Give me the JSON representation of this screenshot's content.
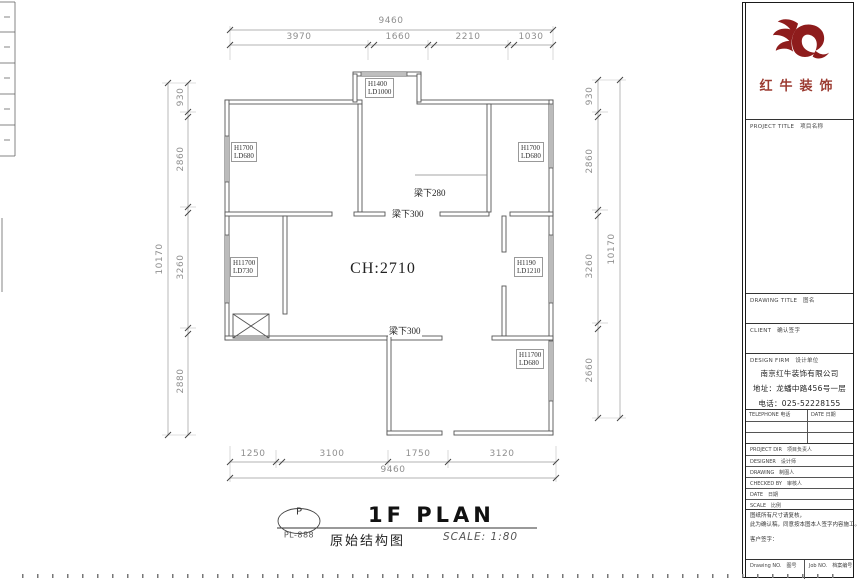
{
  "plan": {
    "bubble_letter": "P",
    "bubble_code": "PL-888",
    "drawing_name": "原始结构图",
    "title": "1F PLAN",
    "scale_label": "SCALE: 1:80",
    "ceiling_height": "CH:2710",
    "beams": {
      "beam1": "梁下280",
      "beam2": "梁下300",
      "beam3": "梁下300"
    },
    "windows": {
      "top_bay": {
        "l1": "H1400",
        "l2": "LD1000"
      },
      "left_top": {
        "l1": "H1700",
        "l2": "LD680"
      },
      "right_top": {
        "l1": "H1700",
        "l2": "LD680"
      },
      "left_mid": {
        "l1": "H11700",
        "l2": "LD730"
      },
      "right_mid": {
        "l1": "H1190",
        "l2": "LD1210"
      },
      "right_bottom": {
        "l1": "H11700",
        "l2": "LD680"
      }
    }
  },
  "dimensions": {
    "top": {
      "total": "9460",
      "segments": [
        "3970",
        "1660",
        "2210",
        "1030"
      ]
    },
    "bottom": {
      "total": "9460",
      "segments": [
        "1250",
        "3100",
        "1750",
        "3120"
      ]
    },
    "left": {
      "total": "10170",
      "segments": [
        "930",
        "2860",
        "3260",
        "2880"
      ]
    },
    "right": {
      "total": "10170",
      "segments": [
        "930",
        "2860",
        "3260",
        "2660"
      ]
    }
  },
  "title_block": {
    "brand": "红牛装饰",
    "project_title_head": "PROJECT TITLE　项目名称",
    "drawing_title_head": "DRAWING TITLE　图名",
    "client_head": "CLIENT　确认签字",
    "firm_head": "DESIGN FIRM　设计单位",
    "company_name": "南京红牛装饰有限公司",
    "company_address": "地址：龙蟠中路456号一层",
    "company_phone": "电话：025-52228155",
    "contact_left": "TELEPHONE 电话",
    "contact_right": "DATE 日期",
    "rows": [
      "PROJECT DIR　项目负责人",
      "DESIGNER　设计师",
      "DRAWING　制图人",
      "CHECKED BY　审核人",
      "DATE　日期",
      "SCALE　比例"
    ],
    "note1": "图纸所有尺寸请复核，",
    "note2": "此为确认稿，同意按本图本人签字内容施工。",
    "note3": "客户签字：",
    "footer_left": "Drawing NO.　图号",
    "footer_right": "Job NO.　档案编号"
  }
}
